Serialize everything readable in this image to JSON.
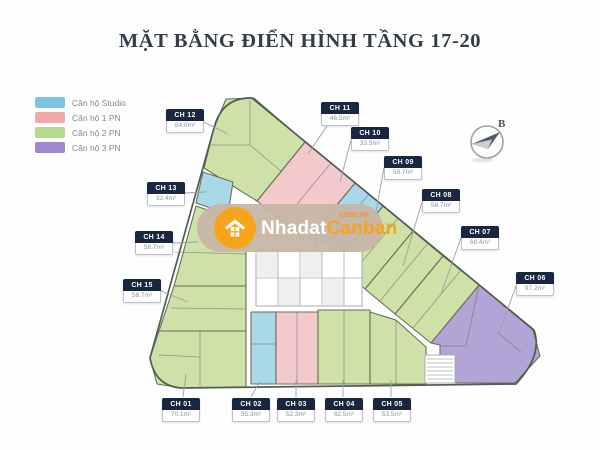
{
  "title": "MẶT BẰNG ĐIỂN HÌNH TẦNG 17-20",
  "legend": {
    "items": [
      {
        "label": "Căn hộ Studio",
        "color": "#7cc4e0",
        "type": "studio"
      },
      {
        "label": "Căn hộ 1 PN",
        "color": "#f2a8a8",
        "type": "pn1"
      },
      {
        "label": "Căn hộ 2 PN",
        "color": "#b5d98d",
        "type": "pn2"
      },
      {
        "label": "Căn hộ 3 PN",
        "color": "#9d89cf",
        "type": "pn3"
      }
    ]
  },
  "compass": {
    "label": "B"
  },
  "watermark": {
    "name_white": "Nhadat",
    "name_orange": "Canban",
    "domain": "com.vn",
    "pill_color": "#c7b6a6",
    "accent": "#f7a41d"
  },
  "plan": {
    "outline_path": "M 214,128 Q 222,97 252,98 L 534,330 Q 543,355 516,384 L 181,388 Q 155,386 150,358 Z",
    "outline_color": "#525c52",
    "unit_stroke": "#687059",
    "fills": {
      "studio": "#a9d9e8",
      "pn1": "#f4c9cc",
      "pn2": "#cde1a9",
      "pn3": "#b3a4d7"
    },
    "leader_color": "#9aa1a8",
    "units": [
      {
        "code": "CH 01",
        "area": "70.1m²",
        "type": "pn2",
        "points": "159,331 246,331 246,387 182,388 157,384 150,358",
        "label": [
          162,
          398
        ],
        "leader": "183,397 186,374",
        "details": [
          "200,331 200,386",
          "159,355 200,357"
        ]
      },
      {
        "code": "CH 02",
        "area": "35.3m²",
        "type": "studio",
        "points": "251,312 276,312 276,384 251,384",
        "label": [
          232,
          398
        ],
        "leader": "251,397 260,381",
        "details": [
          "251,344 276,344"
        ]
      },
      {
        "code": "CH 03",
        "area": "52.3m²",
        "type": "pn1",
        "points": "276,312 318,312 318,384 276,384",
        "label": [
          277,
          398
        ],
        "leader": "296,397 296,380",
        "details": [
          "297,312 297,384"
        ]
      },
      {
        "code": "CH 04",
        "area": "62.5m²",
        "type": "pn2",
        "points": "318,310 370,310 370,384 318,384",
        "label": [
          325,
          398
        ],
        "leader": "343,397 343,380",
        "details": [
          "344,310 344,384"
        ]
      },
      {
        "code": "CH 05",
        "area": "53.5m²",
        "type": "pn2",
        "points": "370,312 396,320 426,347 426,384 370,384",
        "label": [
          373,
          398
        ],
        "leader": "391,397 391,380",
        "details": [
          "396,320 396,384"
        ]
      },
      {
        "code": "CH 06",
        "area": "97.2m²",
        "type": "pn3",
        "points": "479,285 533,330 540,356 515,383 440,383 440,345 431,343",
        "label": [
          516,
          272
        ],
        "leader": "516,286 498,336",
        "details": [
          "479,285 466,346 440,346",
          "497,332 521,352"
        ]
      },
      {
        "code": "CH 07",
        "area": "68.4m²",
        "type": "pn2",
        "points": "443,256 479,285 431,343 395,314",
        "label": [
          461,
          226
        ],
        "leader": "461,238 441,294",
        "details": [
          "461,270 413,328"
        ]
      },
      {
        "code": "CH 08",
        "area": "58.7m²",
        "type": "pn2",
        "points": "413,231 443,256 395,314 365,289",
        "label": [
          422,
          189
        ],
        "leader": "422,202 403,266",
        "details": [
          "428,243 380,301"
        ]
      },
      {
        "code": "CH 09",
        "area": "58.7m²",
        "type": "pn2",
        "points": "383,206 413,231 365,289 335,264",
        "label": [
          384,
          156
        ],
        "leader": "384,168 371,238",
        "details": [
          "398,218 350,276"
        ]
      },
      {
        "code": "CH 10",
        "area": "33.5m²",
        "type": "studio",
        "points": "355,183 383,206 335,264 307,241",
        "label": [
          351,
          127
        ],
        "leader": "351,140 340,182",
        "details": [
          "369,194 321,252"
        ]
      },
      {
        "code": "CH 11",
        "area": "46.5m²",
        "type": "pn1",
        "points": "305,142 355,183 307,241 257,201",
        "label": [
          321,
          102
        ],
        "leader": "327,126 308,154",
        "details": [
          "331,163 283,221"
        ]
      },
      {
        "code": "CH 12",
        "area": "84.0m²",
        "type": "pn2",
        "points": "214,128 226,99 254,98 305,142 257,201 204,168",
        "label": [
          166,
          109
        ],
        "leader": "204,122 228,134",
        "details": [
          "250,100 250,145 208,145",
          "250,145 282,172"
        ]
      },
      {
        "code": "CH 13",
        "area": "33.4m²",
        "type": "studio",
        "points": "203,172 233,182 228,214 196,203",
        "label": [
          147,
          182
        ],
        "leader": "185,193 206,192",
        "details": []
      },
      {
        "code": "CH 14",
        "area": "58.7m²",
        "type": "pn2",
        "points": "196,206 228,217 246,231 246,286 174,286",
        "label": [
          135,
          231
        ],
        "leader": "173,243 198,242",
        "details": [
          "175,252 246,254"
        ]
      },
      {
        "code": "CH 15",
        "area": "58.7m²",
        "type": "pn2",
        "points": "174,286 246,286 246,331 159,331",
        "label": [
          123,
          279
        ],
        "leader": "161,291 188,302",
        "details": [
          "171,308 246,309"
        ]
      }
    ],
    "core": {
      "x": 256,
      "y": 250,
      "w": 106,
      "h": 56,
      "stroke": "#a7adb3",
      "cell_fill": "#edeff0"
    },
    "stairs": {
      "x": 425,
      "y": 355,
      "w": 30,
      "h": 28,
      "stroke": "#a7adb3"
    }
  }
}
